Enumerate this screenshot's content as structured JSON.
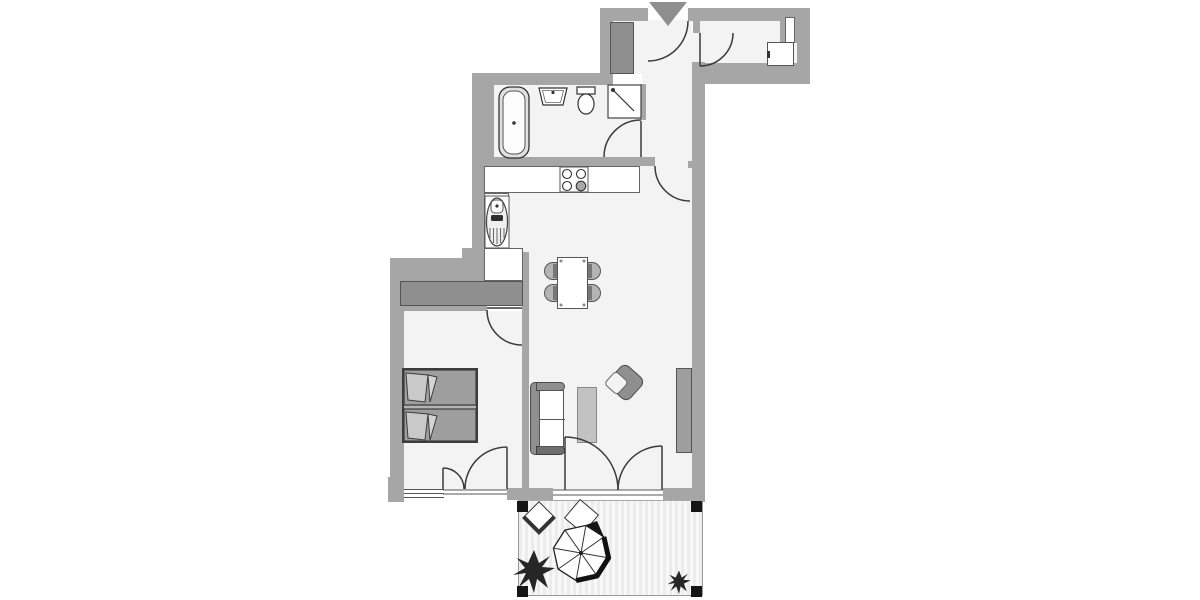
{
  "title": "apartment-floor-plan",
  "palette": {
    "wall": "#a6a6a6",
    "floor": "#f3f3f3",
    "line": "#3a3a3a",
    "furn_dark": "#8f8f8f",
    "furn_mid": "#9e9e9e",
    "furn_light": "#c2c2c2",
    "white": "#ffffff",
    "dark": "#161616",
    "stripe_a": "#ececec",
    "stripe_b": "#f8f8f8"
  },
  "rooms": [
    {
      "name": "entrance-hall",
      "features": [
        "entrance-door",
        "entrance-arrow-marker",
        "hall-closet"
      ]
    },
    {
      "name": "storage-room",
      "features": [
        "door",
        "washing-machine",
        "wall-niche"
      ]
    },
    {
      "name": "bathroom",
      "features": [
        "bathtub",
        "wash-basin",
        "toilet",
        "shower",
        "door",
        "duct-shaft"
      ]
    },
    {
      "name": "open-kitchen",
      "features": [
        "l-shaped-counter",
        "stove-four-burners",
        "kitchen-sink"
      ]
    },
    {
      "name": "dining-area",
      "features": [
        "dining-table",
        "four-chairs"
      ]
    },
    {
      "name": "living-room",
      "features": [
        "sofa-two-seat",
        "coffee-table",
        "armchair",
        "sideboard",
        "french-doors-to-terrace",
        "entry-door"
      ]
    },
    {
      "name": "bedroom",
      "features": [
        "double-bed-with-pillows",
        "built-in-wardrobe",
        "door",
        "window",
        "french-door-to-outside"
      ]
    },
    {
      "name": "terrace",
      "features": [
        "striped-decking",
        "parasol",
        "side-table",
        "folding-chair",
        "large-plant",
        "small-plant",
        "four-corner-posts"
      ]
    }
  ],
  "door_arcs": 9,
  "orientation_marker": "gray-triangle-at-entrance"
}
